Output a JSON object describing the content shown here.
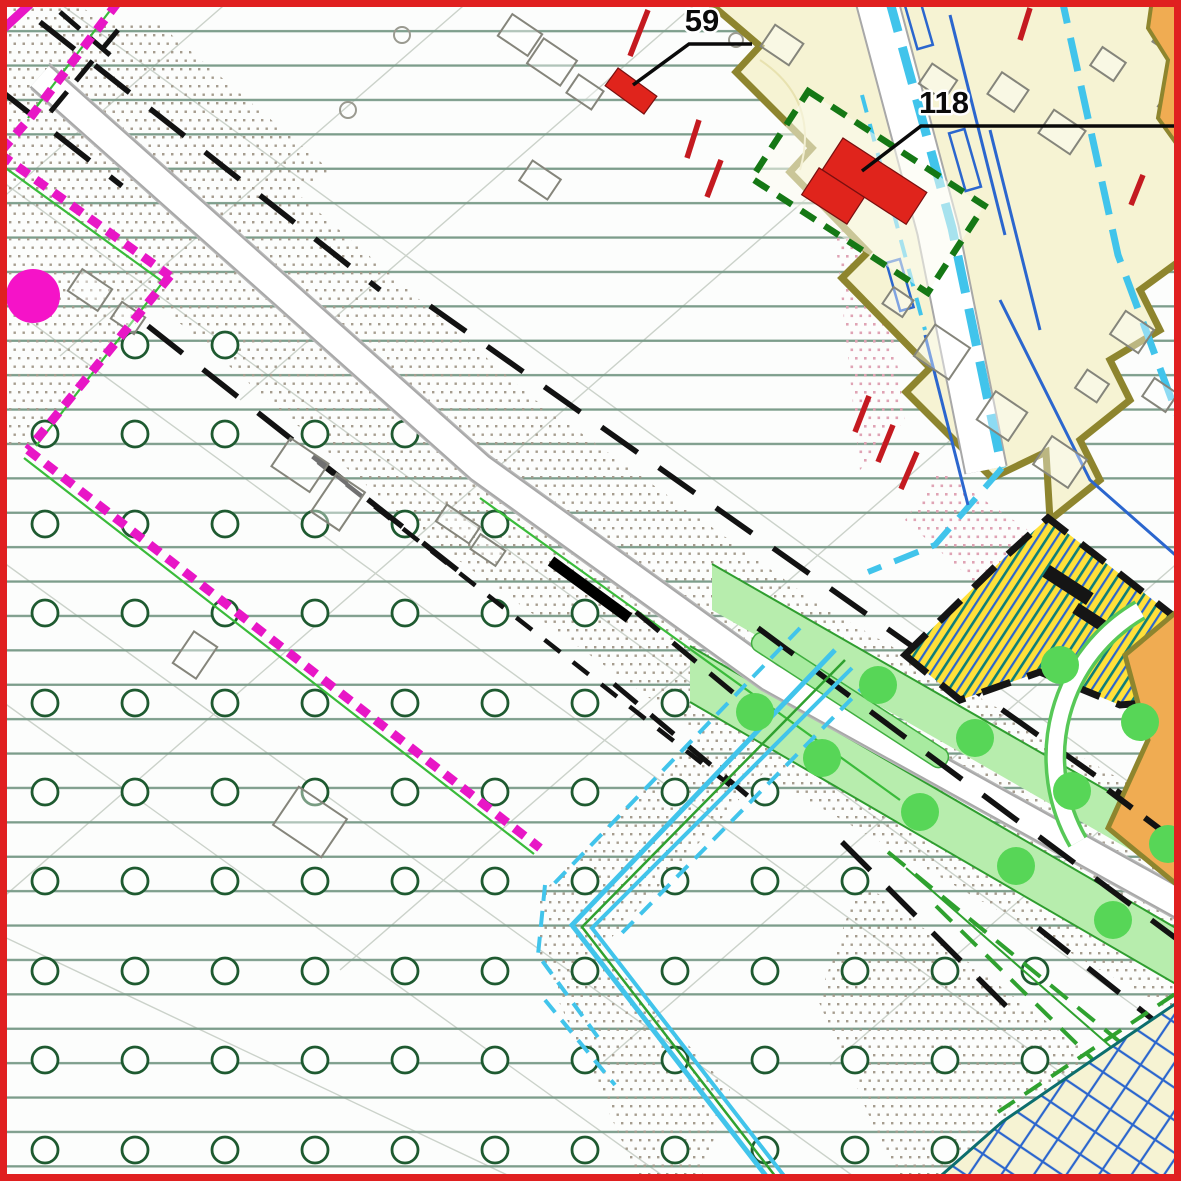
{
  "map": {
    "title": "zoning-plan-map",
    "labels": [
      {
        "id": "building-59",
        "text": "59"
      },
      {
        "id": "building-118",
        "text": "118"
      }
    ],
    "colors": {
      "frame_red": "#E02020",
      "field_line_green": "#7C9D8B",
      "orchard_circle_green": "#1E5A30",
      "stipple_gray": "#A59C8E",
      "stipple_pink": "#DFA3B4",
      "road_edge_gray": "#A8A8A8",
      "boundary_black": "#121212",
      "boundary_magenta": "#E816C6",
      "water_cyan": "#41C4EB",
      "parcel_blue": "#2B66CE",
      "residential_fill": "#F6F3D3",
      "residential_border": "#8E852E",
      "building_red": "#E0241C",
      "building_outline_gray": "#85857B",
      "protected_green_dash": "#157815",
      "verge_green": "#B7EDAD",
      "tree_green": "#57D657",
      "stripe_zone_yellow": "#FFE03A",
      "stripe_teal": "#0F7D7A",
      "orange_zone": "#F0AC52",
      "hatch_red": "#C41A20"
    }
  }
}
